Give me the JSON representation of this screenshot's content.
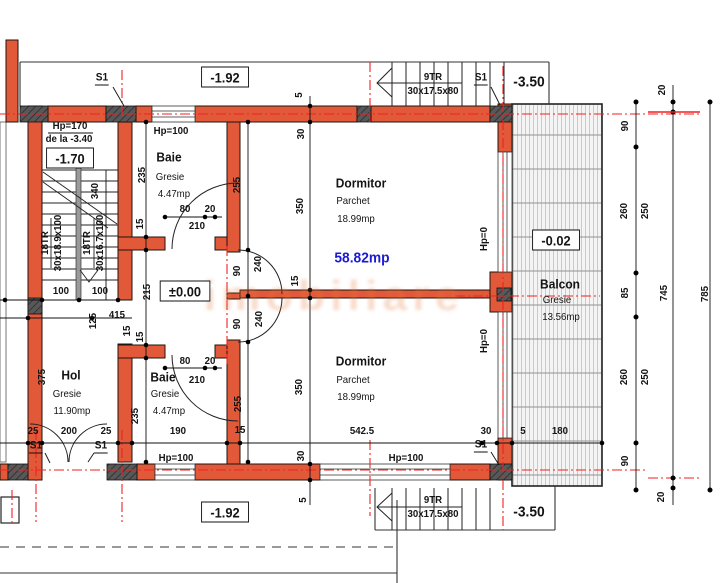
{
  "drawing": {
    "watermark": "imobiliare",
    "wall_color": "#e2593a",
    "axis_color": "#ee2222",
    "total_area_color": "#1b1bd0"
  },
  "labels": [
    {
      "t": "S1",
      "x": 102,
      "y": 79,
      "cls": "marker",
      "n": "marker-s1-top-left"
    },
    {
      "t": "-1.92",
      "x": 225,
      "y": 77,
      "cls": "level",
      "n": "level-top"
    },
    {
      "t": "9TR",
      "x": 433,
      "y": 77,
      "n": "stair-top-steps"
    },
    {
      "t": "30x17.5x80",
      "x": 433,
      "y": 91,
      "n": "stair-top-size"
    },
    {
      "t": "S1",
      "x": 481,
      "y": 79,
      "cls": "marker",
      "n": "marker-s1-top-right"
    },
    {
      "t": "-3.50",
      "x": 529,
      "y": 82,
      "cls": "levelplain",
      "n": "level-stair-top"
    },
    {
      "t": "20",
      "x": 662,
      "y": 90,
      "r": 1
    },
    {
      "t": "90",
      "x": 625,
      "y": 126,
      "r": 1
    },
    {
      "t": "260",
      "x": 624,
      "y": 211,
      "r": 1
    },
    {
      "t": "250",
      "x": 645,
      "y": 211,
      "r": 1
    },
    {
      "t": "85",
      "x": 625,
      "y": 293,
      "r": 1
    },
    {
      "t": "745",
      "x": 664,
      "y": 293,
      "r": 1
    },
    {
      "t": "785",
      "x": 705,
      "y": 294,
      "r": 1
    },
    {
      "t": "260",
      "x": 624,
      "y": 377,
      "r": 1
    },
    {
      "t": "250",
      "x": 645,
      "y": 377,
      "r": 1
    },
    {
      "t": "90",
      "x": 625,
      "y": 461,
      "r": 1
    },
    {
      "t": "20",
      "x": 661,
      "y": 497,
      "r": 1
    },
    {
      "t": "Hp=170",
      "x": 70,
      "y": 126,
      "n": "parapet-stair"
    },
    {
      "t": "de la -3.40",
      "x": 69,
      "y": 139,
      "n": "parapet-stair-from"
    },
    {
      "t": "-1.70",
      "x": 70,
      "y": 158,
      "cls": "level",
      "n": "level-stairwell"
    },
    {
      "t": "18TR",
      "x": 45,
      "y": 243,
      "r": 1,
      "n": "stair-flight1-steps"
    },
    {
      "t": "30x18.9x100",
      "x": 58,
      "y": 243,
      "r": 1,
      "n": "stair-flight1-size"
    },
    {
      "t": "18TR",
      "x": 87,
      "y": 243,
      "r": 1,
      "n": "stair-flight2-steps"
    },
    {
      "t": "30x16.7x100",
      "x": 100,
      "y": 243,
      "r": 1,
      "n": "stair-flight2-size"
    },
    {
      "t": "340",
      "x": 95,
      "y": 191,
      "r": 1
    },
    {
      "t": "100",
      "x": 61,
      "y": 291
    },
    {
      "t": "100",
      "x": 100,
      "y": 291
    },
    {
      "t": "125",
      "x": 93,
      "y": 321,
      "r": 1
    },
    {
      "t": "415",
      "x": 117,
      "y": 315
    },
    {
      "t": "15",
      "x": 127,
      "y": 331,
      "r": 1
    },
    {
      "t": "375",
      "x": 42,
      "y": 377,
      "r": 1
    },
    {
      "t": "Hol",
      "x": 71,
      "y": 375,
      "cls": "room",
      "n": "room-hol"
    },
    {
      "t": "Gresie",
      "x": 67,
      "y": 394,
      "cls": "sub",
      "n": "room-hol-finish"
    },
    {
      "t": "11.90mp",
      "x": 72,
      "y": 411,
      "cls": "sub",
      "n": "room-hol-area"
    },
    {
      "t": "25",
      "x": 33,
      "y": 431
    },
    {
      "t": "200",
      "x": 69,
      "y": 431
    },
    {
      "t": "25",
      "x": 106,
      "y": 431
    },
    {
      "t": "S1",
      "x": 36,
      "y": 447,
      "cls": "marker",
      "n": "marker-s1-entry-left"
    },
    {
      "t": "S1",
      "x": 101,
      "y": 447,
      "cls": "marker",
      "n": "marker-s1-entry-right"
    },
    {
      "t": "Hp=100",
      "x": 171,
      "y": 131,
      "n": "parapet-baie-top"
    },
    {
      "t": "Baie",
      "x": 169,
      "y": 157,
      "cls": "room",
      "n": "room-baie-top"
    },
    {
      "t": "Gresie",
      "x": 170,
      "y": 177,
      "cls": "sub",
      "n": "room-baie-top-finish"
    },
    {
      "t": "4.47mp",
      "x": 174,
      "y": 194,
      "cls": "sub",
      "n": "room-baie-top-area"
    },
    {
      "t": "235",
      "x": 142,
      "y": 175,
      "r": 1
    },
    {
      "t": "15",
      "x": 140,
      "y": 224,
      "r": 1
    },
    {
      "t": "215",
      "x": 147,
      "y": 292,
      "r": 1
    },
    {
      "t": "15",
      "x": 140,
      "y": 337,
      "r": 1
    },
    {
      "t": "235",
      "x": 135,
      "y": 416,
      "r": 1
    },
    {
      "t": "80",
      "x": 185,
      "y": 209
    },
    {
      "t": "20",
      "x": 210,
      "y": 209
    },
    {
      "t": "210",
      "x": 197,
      "y": 226
    },
    {
      "t": "±0.00",
      "x": 185,
      "y": 291,
      "cls": "level",
      "n": "level-hall"
    },
    {
      "t": "Baie",
      "x": 163,
      "y": 377,
      "cls": "room",
      "n": "room-baie-bottom"
    },
    {
      "t": "Gresie",
      "x": 165,
      "y": 394,
      "cls": "sub",
      "n": "room-baie-bottom-finish"
    },
    {
      "t": "4.47mp",
      "x": 169,
      "y": 411,
      "cls": "sub",
      "n": "room-baie-bottom-area"
    },
    {
      "t": "80",
      "x": 185,
      "y": 361
    },
    {
      "t": "20",
      "x": 210,
      "y": 361
    },
    {
      "t": "210",
      "x": 197,
      "y": 380
    },
    {
      "t": "190",
      "x": 178,
      "y": 431
    },
    {
      "t": "Hp=100",
      "x": 176,
      "y": 458,
      "n": "parapet-baie-bottom"
    },
    {
      "t": "15",
      "x": 240,
      "y": 430
    },
    {
      "t": "255",
      "x": 237,
      "y": 185,
      "r": 1
    },
    {
      "t": "90",
      "x": 237,
      "y": 271,
      "r": 1
    },
    {
      "t": "240",
      "x": 258,
      "y": 264,
      "r": 1
    },
    {
      "t": "90",
      "x": 237,
      "y": 324,
      "r": 1
    },
    {
      "t": "240",
      "x": 259,
      "y": 319,
      "r": 1
    },
    {
      "t": "255",
      "x": 238,
      "y": 404,
      "r": 1
    },
    {
      "t": "5",
      "x": 299,
      "y": 95,
      "r": 1
    },
    {
      "t": "30",
      "x": 301,
      "y": 134,
      "r": 1
    },
    {
      "t": "350",
      "x": 300,
      "y": 206,
      "r": 1
    },
    {
      "t": "15",
      "x": 295,
      "y": 281,
      "r": 1
    },
    {
      "t": "350",
      "x": 299,
      "y": 387,
      "r": 1
    },
    {
      "t": "30",
      "x": 301,
      "y": 456,
      "r": 1
    },
    {
      "t": "5",
      "x": 303,
      "y": 500,
      "r": 1
    },
    {
      "t": "Dormitor",
      "x": 361,
      "y": 183,
      "cls": "room",
      "n": "room-dormitor-top"
    },
    {
      "t": "Parchet",
      "x": 353,
      "y": 201,
      "cls": "sub",
      "n": "room-dormitor-top-finish"
    },
    {
      "t": "18.99mp",
      "x": 356,
      "y": 219,
      "cls": "sub",
      "n": "room-dormitor-top-area"
    },
    {
      "t": "58.82mp",
      "x": 362,
      "y": 258,
      "cls": "total",
      "n": "total-area"
    },
    {
      "t": "Dormitor",
      "x": 361,
      "y": 361,
      "cls": "room",
      "n": "room-dormitor-bottom"
    },
    {
      "t": "Parchet",
      "x": 353,
      "y": 380,
      "cls": "sub",
      "n": "room-dormitor-bottom-finish"
    },
    {
      "t": "18.99mp",
      "x": 356,
      "y": 397,
      "cls": "sub",
      "n": "room-dormitor-bottom-area"
    },
    {
      "t": "Hp=0",
      "x": 484,
      "y": 239,
      "r": 1,
      "n": "parapet-window-top"
    },
    {
      "t": "Hp=0",
      "x": 484,
      "y": 341,
      "r": 1,
      "n": "parapet-window-bottom"
    },
    {
      "t": "542.5",
      "x": 362,
      "y": 431
    },
    {
      "t": "Hp=100",
      "x": 406,
      "y": 458,
      "n": "parapet-dormitor-bottom"
    },
    {
      "t": "30",
      "x": 486,
      "y": 431
    },
    {
      "t": "5",
      "x": 523,
      "y": 431
    },
    {
      "t": "180",
      "x": 560,
      "y": 431
    },
    {
      "t": "S1",
      "x": 481,
      "y": 446,
      "cls": "marker",
      "n": "marker-s1-bottom-right"
    },
    {
      "t": "-0.02",
      "x": 556,
      "y": 240,
      "cls": "level",
      "n": "level-balcon"
    },
    {
      "t": "Balcon",
      "x": 560,
      "y": 284,
      "cls": "room",
      "n": "room-balcon"
    },
    {
      "t": "Gresie",
      "x": 557,
      "y": 300,
      "cls": "sub",
      "n": "room-balcon-finish"
    },
    {
      "t": "13.56mp",
      "x": 561,
      "y": 317,
      "cls": "sub",
      "n": "room-balcon-area"
    },
    {
      "t": "-1.92",
      "x": 225,
      "y": 512,
      "cls": "level",
      "n": "level-bottom"
    },
    {
      "t": "9TR",
      "x": 433,
      "y": 500,
      "n": "stair-bottom-steps"
    },
    {
      "t": "30x17.5x80",
      "x": 433,
      "y": 514,
      "n": "stair-bottom-size"
    },
    {
      "t": "-3.50",
      "x": 529,
      "y": 512,
      "cls": "levelplain",
      "n": "level-stair-bottom"
    }
  ]
}
